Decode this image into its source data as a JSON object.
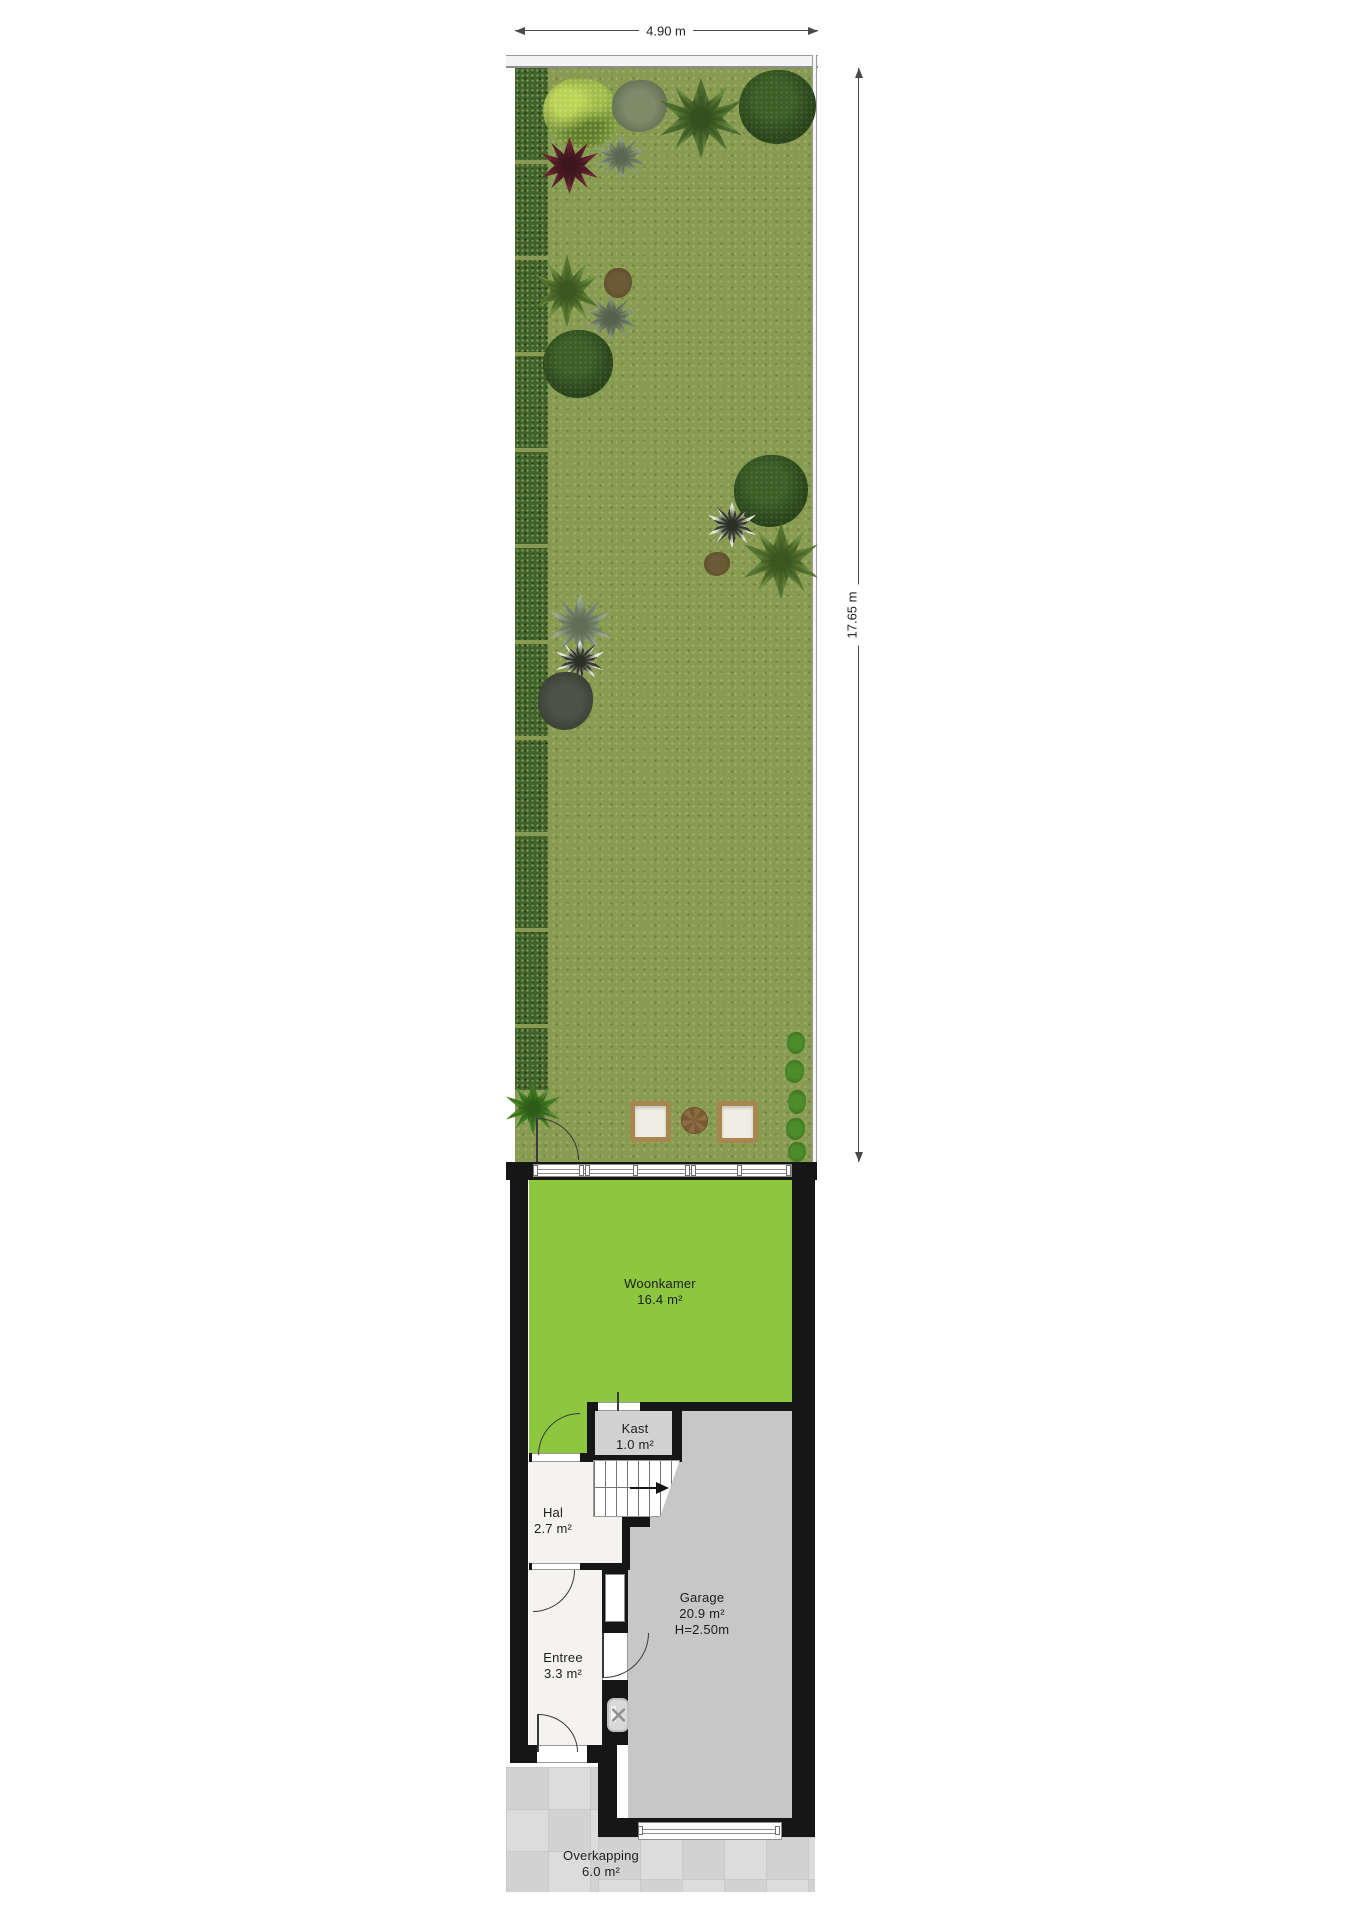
{
  "dimensions": {
    "width": "4.90 m",
    "depth": "17.65 m"
  },
  "rooms": [
    {
      "name": "Woonkamer",
      "area": "16.4 m²"
    },
    {
      "name": "Kast",
      "area": "1.0 m²"
    },
    {
      "name": "Hal",
      "area": "2.7 m²"
    },
    {
      "name": "Entree",
      "area": "3.3 m²"
    },
    {
      "name": "Garage",
      "area": "20.9 m²",
      "height": "H=2.50m"
    },
    {
      "name": "Overkapping",
      "area": "6.0 m²"
    }
  ],
  "colors": {
    "grass": "#879b52",
    "hedge": "#416329",
    "woonkamer_floor": "#8dc63f",
    "kast_floor": "#d2d2d2",
    "garage_floor": "#c7c7c7",
    "hall_floor": "#f4f3f0",
    "wall": "#161616",
    "tile": "#d8d8d8",
    "wood": "#a8864f"
  }
}
